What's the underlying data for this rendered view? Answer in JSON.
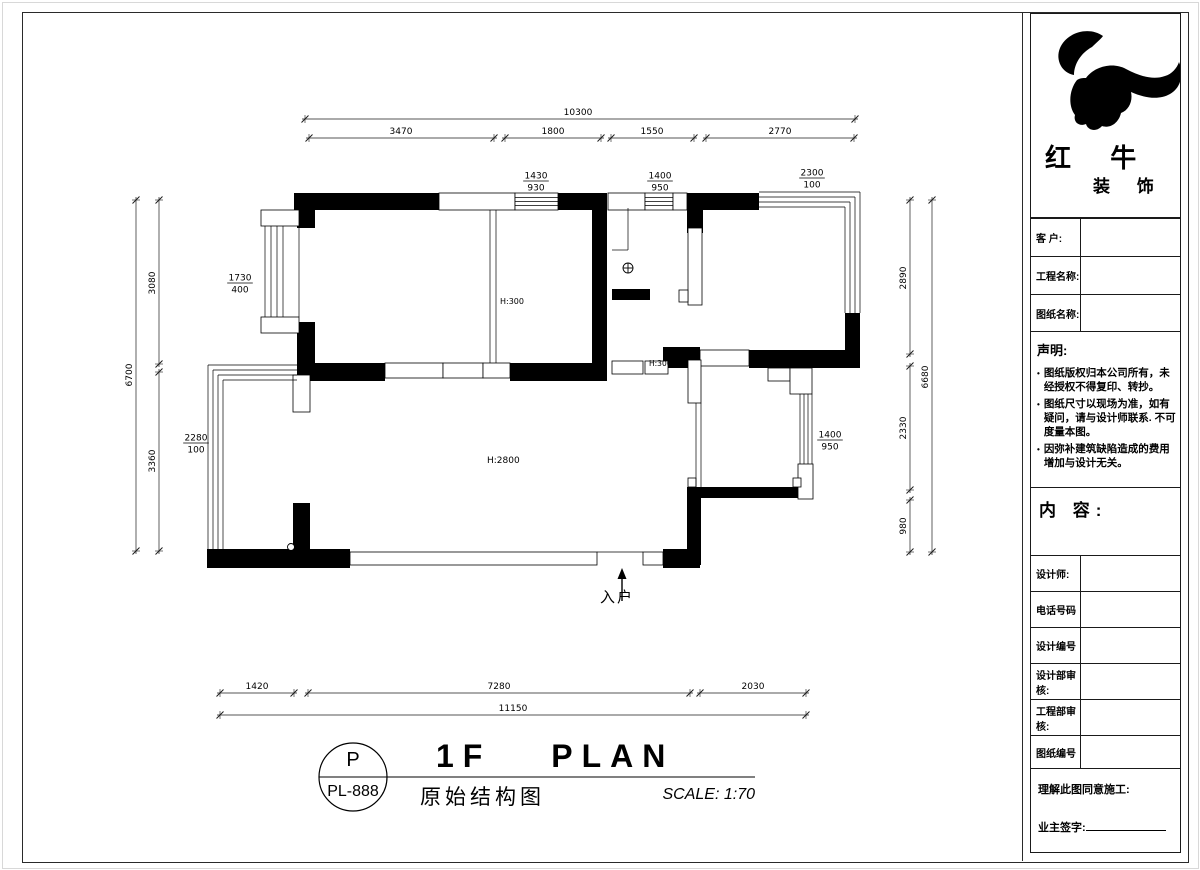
{
  "title_block": {
    "code_top": "P",
    "code_bottom": "PL-888",
    "title_en": "1F PLAN",
    "title_cn": "原始结构图",
    "scale": "SCALE: 1:70"
  },
  "sidebar": {
    "brand": {
      "name_main": "红 牛",
      "name_sub": "装 饰"
    },
    "fields": [
      {
        "label": "客  户:"
      },
      {
        "label": "工程名称:"
      },
      {
        "label": "图纸名称:"
      },
      {
        "label": "设计师:"
      },
      {
        "label": "电话号码"
      },
      {
        "label": "设计编号"
      },
      {
        "label": "设计部审核:"
      },
      {
        "label": "工程部审核:"
      },
      {
        "label": "图纸编号"
      }
    ],
    "statement": {
      "title": "声明:",
      "bullets": [
        "图纸版权归本公司所有，未经授权不得复印、转抄。",
        "图纸尺寸以现场为准，如有疑问，请与设计师联系. 不可度量本图。",
        "因弥补建筑缺陷造成的费用增加与设计无关。"
      ]
    },
    "content_label": "内 容:",
    "footer": {
      "line1": "理解此图同意施工:",
      "line2": "业主签字:"
    }
  },
  "plan": {
    "entry_label": "入户",
    "labels": [
      {
        "t": "H:300",
        "x": 500,
        "y": 304,
        "size": 8,
        "anchor": "start"
      },
      {
        "t": "H:300",
        "x": 649,
        "y": 366,
        "size": 7.5,
        "anchor": "start"
      },
      {
        "t": "H:2800",
        "x": 487,
        "y": 463,
        "size": 9,
        "anchor": "start"
      }
    ],
    "dims": [
      {
        "x1": 305,
        "y1": 119,
        "x2": 855,
        "y2": 119,
        "label": "10300",
        "lx": 578,
        "ly": 115,
        "vert": false
      },
      {
        "x1": 309,
        "y1": 138,
        "x2": 494,
        "y2": 138,
        "label": "3470",
        "lx": 401,
        "ly": 134,
        "vert": false
      },
      {
        "x1": 505,
        "y1": 138,
        "x2": 601,
        "y2": 138,
        "label": "1800",
        "lx": 553,
        "ly": 134,
        "vert": false
      },
      {
        "x1": 611,
        "y1": 138,
        "x2": 694,
        "y2": 138,
        "label": "1550",
        "lx": 652,
        "ly": 134,
        "vert": false
      },
      {
        "x1": 706,
        "y1": 138,
        "x2": 854,
        "y2": 138,
        "label": "2770",
        "lx": 780,
        "ly": 134,
        "vert": false
      },
      {
        "x1": 136,
        "y1": 200,
        "x2": 136,
        "y2": 551,
        "label": "6700",
        "lx": 132,
        "ly": 375,
        "vert": true
      },
      {
        "x1": 159,
        "y1": 200,
        "x2": 159,
        "y2": 364,
        "label": "3080",
        "lx": 155,
        "ly": 283,
        "vert": true
      },
      {
        "x1": 159,
        "y1": 372,
        "x2": 159,
        "y2": 551,
        "label": "3360",
        "lx": 155,
        "ly": 461,
        "vert": true
      },
      {
        "x1": 910,
        "y1": 200,
        "x2": 910,
        "y2": 354,
        "label": "2890",
        "lx": 906,
        "ly": 278,
        "vert": true
      },
      {
        "x1": 910,
        "y1": 366,
        "x2": 910,
        "y2": 490,
        "label": "2330",
        "lx": 906,
        "ly": 428,
        "vert": true
      },
      {
        "x1": 910,
        "y1": 500,
        "x2": 910,
        "y2": 552,
        "label": "980",
        "lx": 906,
        "ly": 526,
        "vert": true
      },
      {
        "x1": 932,
        "y1": 200,
        "x2": 932,
        "y2": 552,
        "label": "6680",
        "lx": 928,
        "ly": 377,
        "vert": true
      },
      {
        "x1": 220,
        "y1": 693,
        "x2": 294,
        "y2": 693,
        "label": "1420",
        "lx": 257,
        "ly": 689,
        "vert": false
      },
      {
        "x1": 308,
        "y1": 693,
        "x2": 690,
        "y2": 693,
        "label": "7280",
        "lx": 499,
        "ly": 689,
        "vert": false
      },
      {
        "x1": 700,
        "y1": 693,
        "x2": 806,
        "y2": 693,
        "label": "2030",
        "lx": 753,
        "ly": 689,
        "vert": false
      },
      {
        "x1": 220,
        "y1": 715,
        "x2": 806,
        "y2": 715,
        "label": "11150",
        "lx": 513,
        "ly": 711,
        "vert": false
      }
    ],
    "fractions": [
      {
        "x": 536,
        "y": 181,
        "top": "1430",
        "bot": "930"
      },
      {
        "x": 660,
        "y": 181,
        "top": "1400",
        "bot": "950"
      },
      {
        "x": 812,
        "y": 178,
        "top": "2300",
        "bot": "100"
      },
      {
        "x": 240,
        "y": 283,
        "top": "1730",
        "bot": "400"
      },
      {
        "x": 196,
        "y": 443,
        "top": "2280",
        "bot": "100"
      },
      {
        "x": 830,
        "y": 440,
        "top": "1400",
        "bot": "950"
      }
    ],
    "walls_black": [
      [
        294,
        193,
        145,
        17
      ],
      [
        558,
        193,
        39,
        17
      ],
      [
        592,
        193,
        15,
        188
      ],
      [
        694,
        193,
        65,
        17
      ],
      [
        297,
        193,
        18,
        35
      ],
      [
        297,
        322,
        18,
        59
      ],
      [
        297,
        363,
        88,
        18
      ],
      [
        510,
        363,
        97,
        18
      ],
      [
        612,
        289,
        38,
        11
      ],
      [
        687,
        193,
        16,
        40
      ],
      [
        663,
        347,
        37,
        21
      ],
      [
        749,
        350,
        110,
        18
      ],
      [
        845,
        313,
        15,
        55
      ],
      [
        700,
        487,
        101,
        11
      ],
      [
        687,
        487,
        14,
        78
      ],
      [
        663,
        549,
        37,
        19
      ],
      [
        207,
        549,
        143,
        19
      ],
      [
        293,
        503,
        17,
        48
      ]
    ],
    "walls_white": [
      [
        439,
        193,
        76,
        17
      ],
      [
        515,
        193,
        43,
        17
      ],
      [
        608,
        193,
        37,
        17
      ],
      [
        645,
        193,
        28,
        17
      ],
      [
        673,
        193,
        14,
        17
      ],
      [
        385,
        363,
        58,
        15
      ],
      [
        443,
        363,
        40,
        15
      ],
      [
        483,
        363,
        27,
        15
      ],
      [
        688,
        228,
        14,
        77
      ],
      [
        679,
        290,
        9,
        12
      ],
      [
        293,
        375,
        17,
        37
      ],
      [
        612,
        361,
        31,
        13
      ],
      [
        645,
        361,
        23,
        13
      ],
      [
        700,
        350,
        49,
        16
      ],
      [
        688,
        360,
        13,
        43
      ],
      [
        768,
        368,
        22,
        13
      ],
      [
        790,
        368,
        22,
        26
      ],
      [
        798,
        464,
        15,
        35
      ],
      [
        688,
        478,
        8,
        9
      ],
      [
        793,
        478,
        8,
        9
      ],
      [
        643,
        552,
        20,
        13
      ],
      [
        350,
        552,
        247,
        13
      ],
      [
        261,
        210,
        38,
        16
      ],
      [
        261,
        317,
        38,
        16
      ]
    ],
    "thin_lines": [
      [
        515,
        197.5,
        558,
        197.5
      ],
      [
        515,
        201.5,
        558,
        201.5
      ],
      [
        515,
        205.5,
        558,
        205.5
      ],
      [
        645,
        197.5,
        673,
        197.5
      ],
      [
        645,
        201.5,
        673,
        201.5
      ],
      [
        645,
        205.5,
        673,
        205.5
      ],
      [
        759,
        192,
        860,
        192
      ],
      [
        860,
        192,
        860,
        313
      ],
      [
        759,
        197,
        855,
        197
      ],
      [
        855,
        197,
        855,
        313
      ],
      [
        759,
        202,
        850,
        202
      ],
      [
        850,
        202,
        850,
        313
      ],
      [
        759,
        207,
        845,
        207
      ],
      [
        845,
        207,
        845,
        313
      ],
      [
        265,
        226,
        265,
        317
      ],
      [
        271,
        226,
        271,
        317
      ],
      [
        277,
        226,
        277,
        317
      ],
      [
        283,
        226,
        283,
        317
      ],
      [
        299,
        226,
        299,
        317
      ],
      [
        208,
        549,
        208,
        365
      ],
      [
        208,
        365,
        297,
        365
      ],
      [
        213,
        549,
        213,
        370
      ],
      [
        213,
        370,
        297,
        370
      ],
      [
        218,
        549,
        218,
        375
      ],
      [
        218,
        375,
        297,
        375
      ],
      [
        223,
        549,
        223,
        380
      ],
      [
        223,
        380,
        297,
        380
      ],
      [
        490,
        210,
        490,
        363
      ],
      [
        496,
        210,
        496,
        363
      ],
      [
        612,
        250,
        628,
        250
      ],
      [
        628,
        250,
        628,
        208
      ],
      [
        696,
        403,
        696,
        487
      ],
      [
        701,
        403,
        701,
        487
      ],
      [
        597,
        552,
        643,
        552
      ],
      [
        800,
        394,
        800,
        464
      ],
      [
        804,
        394,
        804,
        464
      ],
      [
        808,
        394,
        808,
        464
      ],
      [
        812,
        394,
        812,
        464
      ]
    ],
    "circles": [
      {
        "cx": 628,
        "cy": 268,
        "r": 5,
        "cross": true
      },
      {
        "cx": 291,
        "cy": 547,
        "r": 3.5,
        "cross": false
      }
    ],
    "entry_arrow": {
      "x": 622,
      "y_tail": 601,
      "y_head": 568
    },
    "entry_label_pos": {
      "x": 604,
      "y": 589
    },
    "title_mark": {
      "line": [
        319,
        777,
        755,
        777
      ],
      "circle": [
        353,
        777,
        34
      ]
    },
    "colors": {
      "ink": "#000000",
      "dim": "#1c1c1c"
    }
  }
}
